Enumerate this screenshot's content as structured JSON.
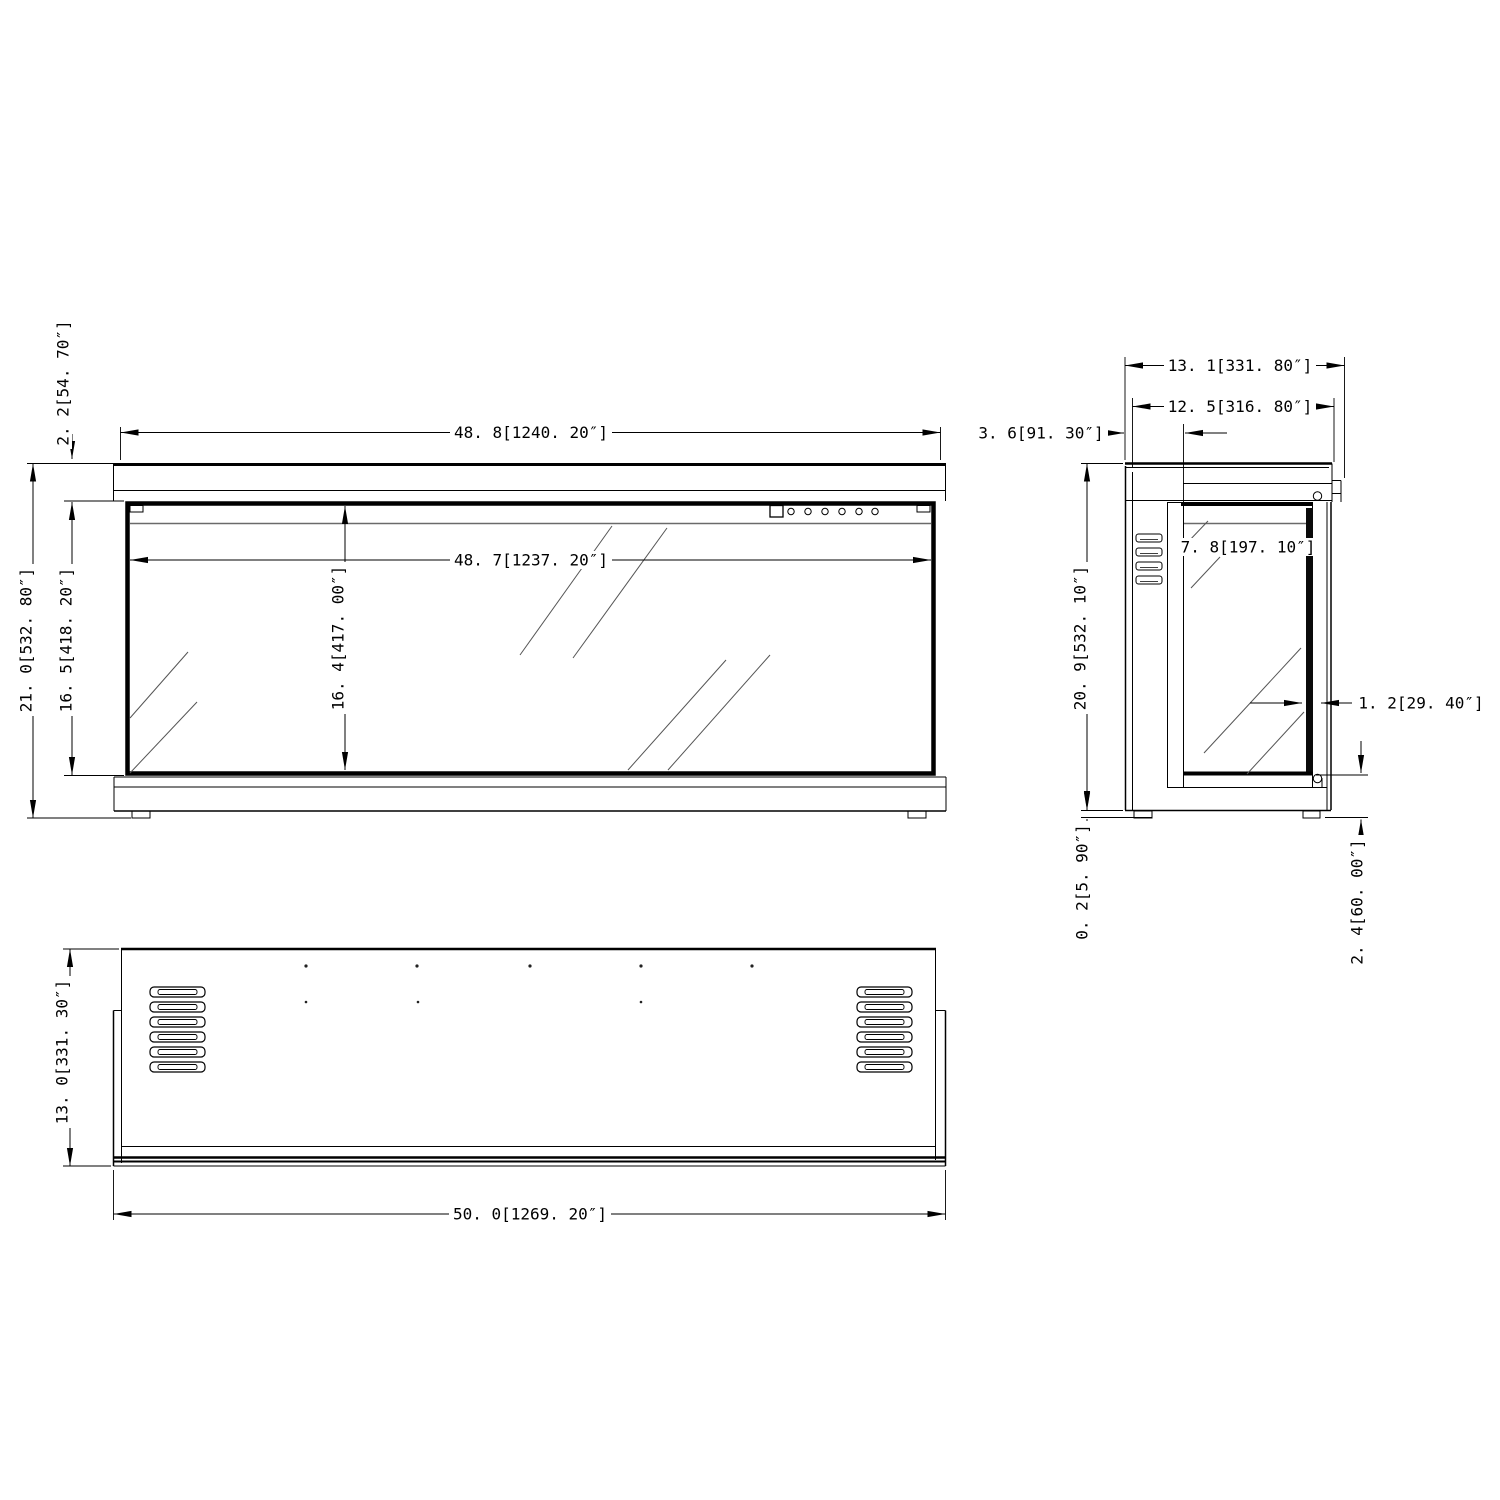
{
  "drawing_type": "three-view technical dimension drawing",
  "colors": {
    "ink": "#000000",
    "soft_line": "#6a6a6a",
    "reflection_line": "#555555",
    "background": "#ffffff"
  },
  "views": {
    "front": {
      "label": "front-view"
    },
    "side": {
      "label": "side-view"
    },
    "bottom": {
      "label": "bottom-view"
    }
  },
  "dims": {
    "front_cap_height": "2. 2[54. 70″]",
    "front_cap_width": "48. 8[1240. 20″]",
    "front_glass_width": "48. 7[1237. 20″]",
    "front_overall_height": "21. 0[532. 80″]",
    "front_frame_height": "16. 5[418. 20″]",
    "front_glass_height": "16. 4[417. 00″]",
    "side_depth_overall": "13. 1[331. 80″]",
    "side_depth_body": "12. 5[316. 80″]",
    "side_front_offset": "3. 6[91. 30″]",
    "side_door_depth": "7. 8[197. 10″]",
    "side_height": "20. 9[532. 10″]",
    "side_glass_thickness": "1. 2[29. 40″]",
    "side_bottom_gap": "0. 2[5. 90″]",
    "side_rear_clearance": "2. 4[60. 00″]",
    "bottom_depth": "13. 0[331. 30″]",
    "bottom_width": "50. 0[1269. 20″]"
  }
}
